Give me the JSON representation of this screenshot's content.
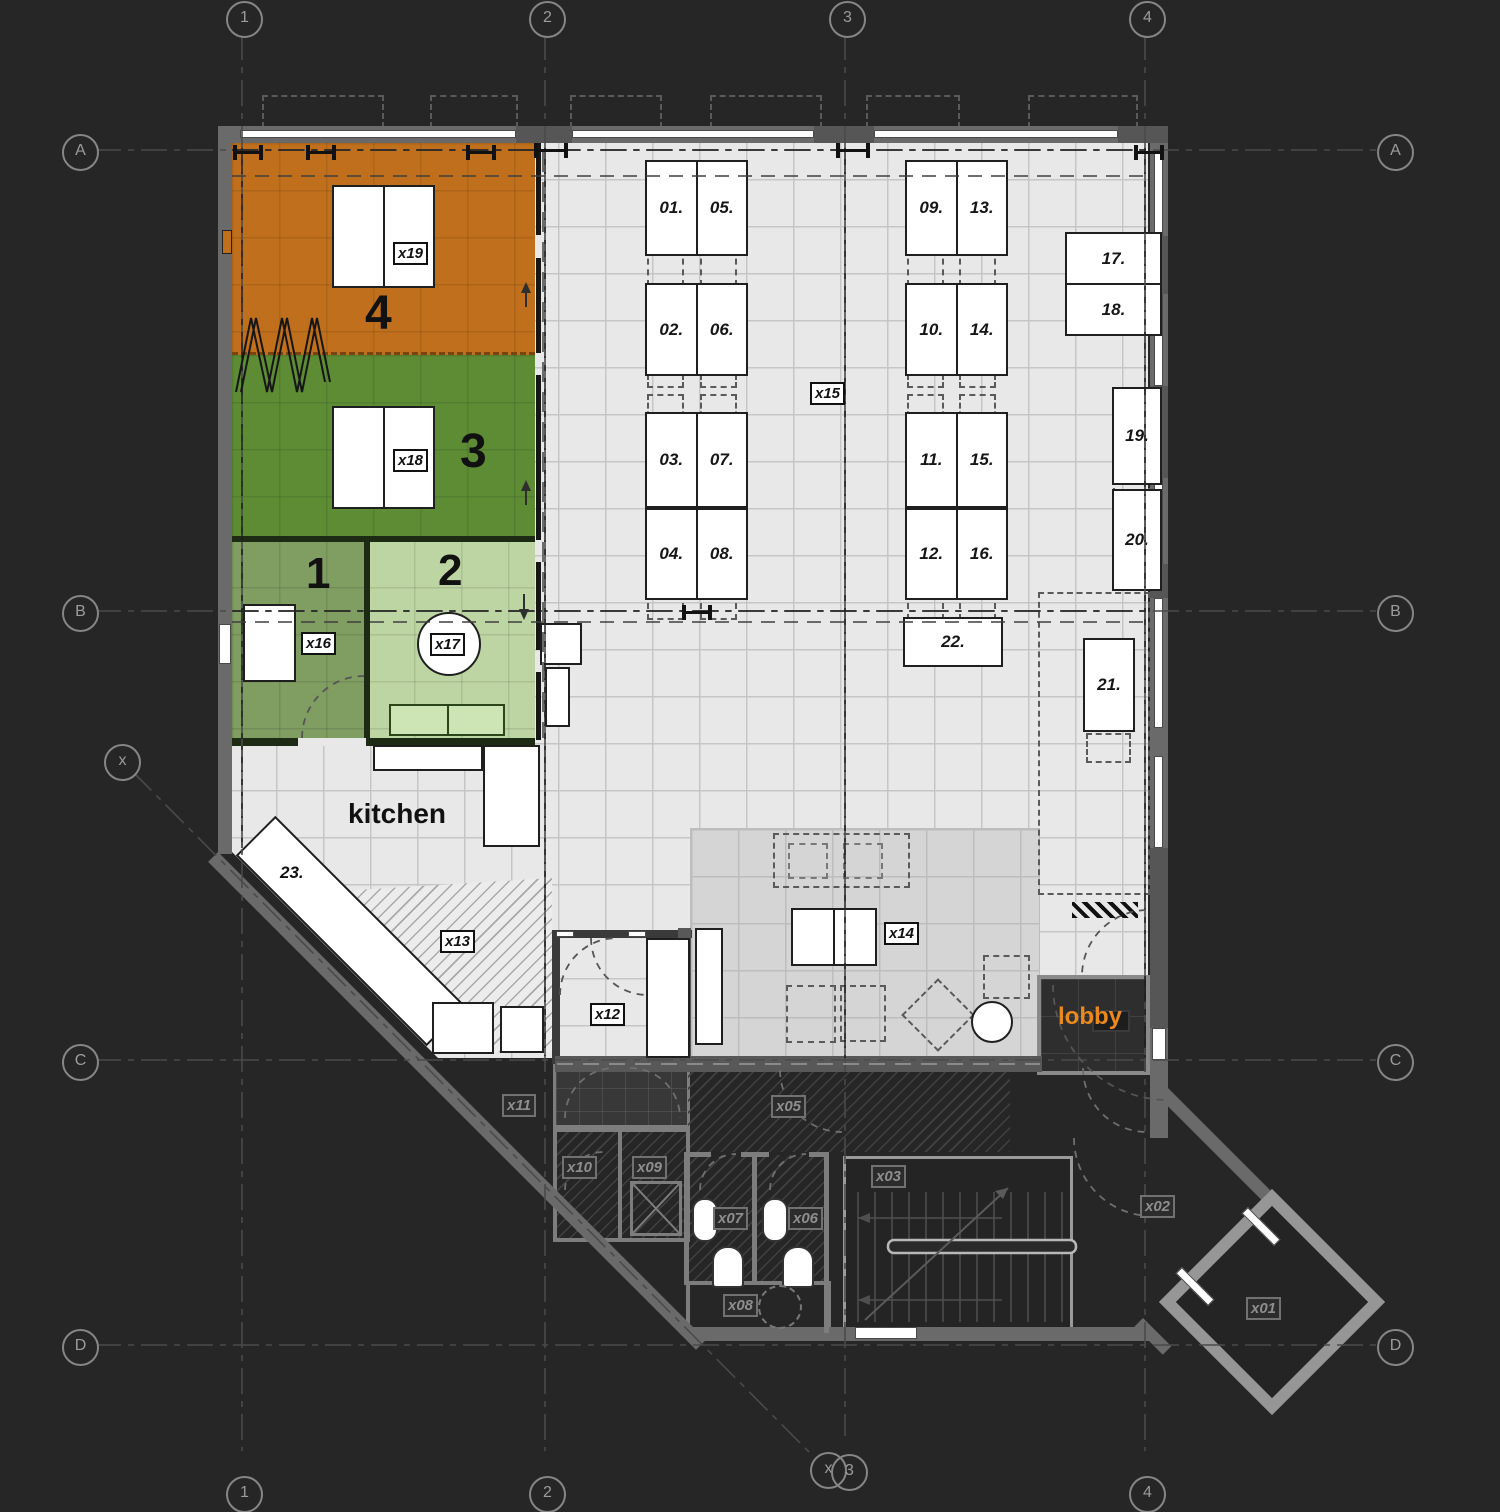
{
  "colors": {
    "background": "#262626",
    "floor": "#e8e8e8",
    "room4_orange": "#c0701c",
    "room3_green": "#5d8c35",
    "room1_sage": "#809d62",
    "room2_lightgreen": "#bdd5a3",
    "lobby_text_orange": "#ea8a1e",
    "wall_gray": "#6a6a6a"
  },
  "grid": {
    "cols": [
      "1",
      "2",
      "3",
      "4"
    ],
    "rows": [
      "A",
      "B",
      "C",
      "D"
    ],
    "aux": "x"
  },
  "rooms": {
    "r1": "1",
    "r2": "2",
    "r3": "3",
    "r4": "4",
    "kitchen": "kitchen",
    "lobby": "lobby"
  },
  "codes": {
    "x01": "x01",
    "x02": "x02",
    "x03": "x03",
    "x05": "x05",
    "x06": "x06",
    "x07": "x07",
    "x08": "x08",
    "x09": "x09",
    "x10": "x10",
    "x11": "x11",
    "x12": "x12",
    "x13": "x13",
    "x14": "x14",
    "x15": "x15",
    "x16": "x16",
    "x17": "x17",
    "x18": "x18",
    "x19": "x19"
  },
  "desks": {
    "d01": "01.",
    "d02": "02.",
    "d03": "03.",
    "d04": "04.",
    "d05": "05.",
    "d06": "06.",
    "d07": "07.",
    "d08": "08.",
    "d09": "09.",
    "d10": "10.",
    "d11": "11.",
    "d12": "12.",
    "d13": "13.",
    "d14": "14.",
    "d15": "15.",
    "d16": "16.",
    "d17": "17.",
    "d18": "18.",
    "d19": "19.",
    "d20": "20.",
    "d21": "21.",
    "d22": "22.",
    "d23": "23."
  }
}
